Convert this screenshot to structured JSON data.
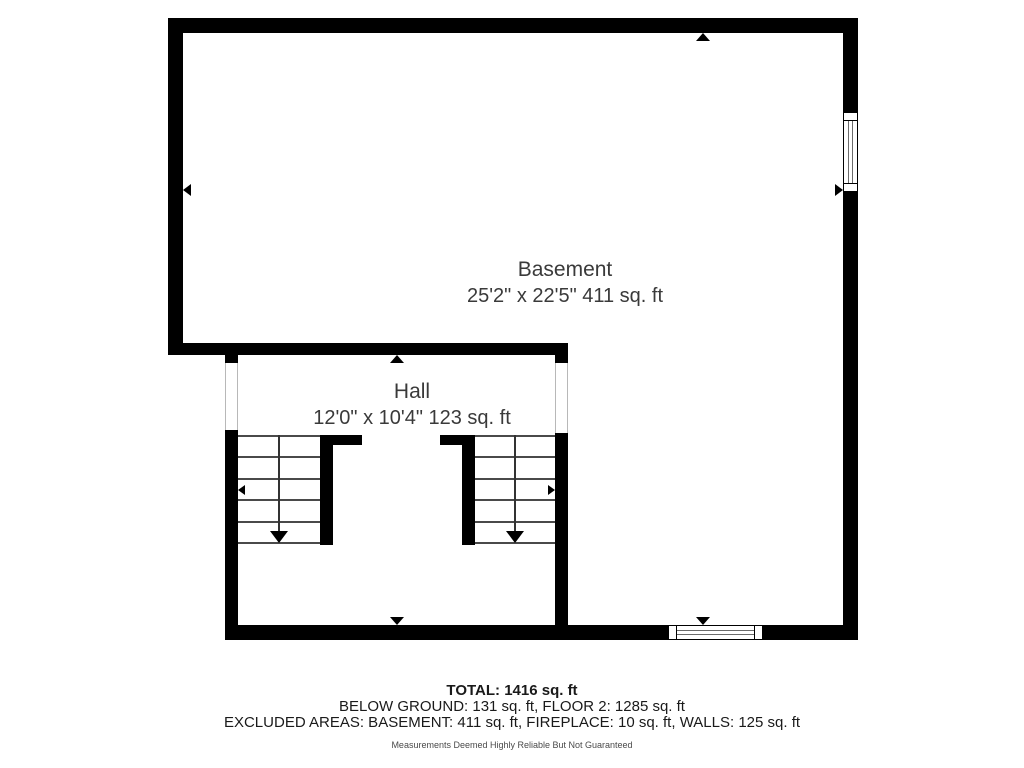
{
  "floorplan": {
    "rooms": [
      {
        "name": "Basement",
        "dimensions": "25'2\" x 22'5\" 411 sq. ft"
      },
      {
        "name": "Hall",
        "dimensions": "12'0\" x 10'4\" 123 sq. ft"
      }
    ],
    "summary": {
      "total": "TOTAL: 1416 sq. ft",
      "breakdown": "BELOW GROUND: 131 sq. ft, FLOOR 2: 1285 sq. ft",
      "excluded": "EXCLUDED AREAS: BASEMENT: 411 sq. ft, FIREPLACE: 10 sq. ft, WALLS: 125 sq. ft",
      "disclaimer": "Measurements Deemed Highly Reliable But Not Guaranteed"
    },
    "colors": {
      "wall": "#000000",
      "background": "#ffffff",
      "stair_line": "#4a4a4a",
      "label_text": "#3a3a3a"
    }
  }
}
